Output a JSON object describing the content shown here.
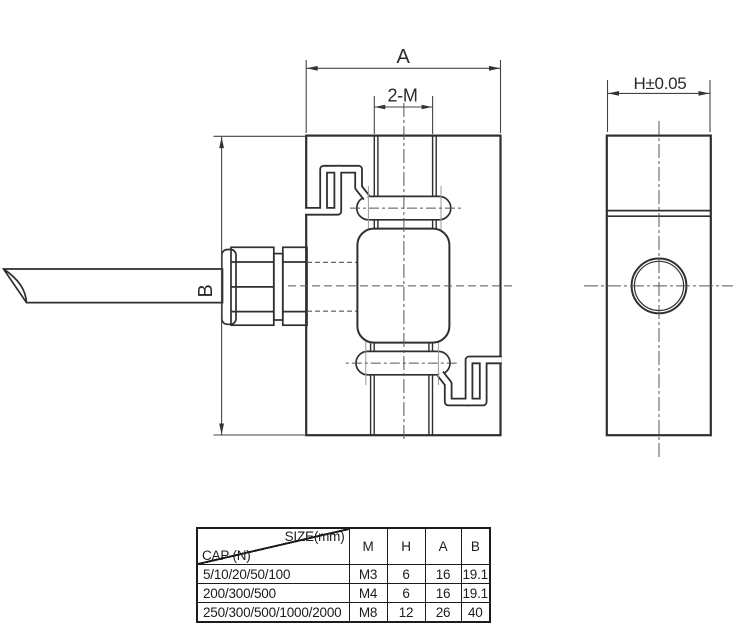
{
  "front_view": {
    "dim_width_label": "A",
    "dim_thread_label": "2-M",
    "dim_height_label": "B"
  },
  "side_view": {
    "dim_thickness_label": "H±0.05"
  },
  "table": {
    "header": {
      "size_label": "SIZE(mm)",
      "cap_label": "CAP (N)",
      "columns": [
        "M",
        "H",
        "A",
        "B"
      ]
    },
    "rows": [
      {
        "cap": "5/10/20/50/100",
        "m": "M3",
        "h": "6",
        "a": "16",
        "b": "19.1"
      },
      {
        "cap": "200/300/500",
        "m": "M4",
        "h": "6",
        "a": "16",
        "b": "19.1"
      },
      {
        "cap": "250/300/500/1000/2000",
        "m": "M8",
        "h": "12",
        "a": "26",
        "b": "40"
      }
    ]
  },
  "colors": {
    "main_line": "#2f2f2f",
    "thin_line": "#9b9b9b",
    "centerline": "#555555",
    "dimension_line": "#444444",
    "background": "#ffffff"
  }
}
